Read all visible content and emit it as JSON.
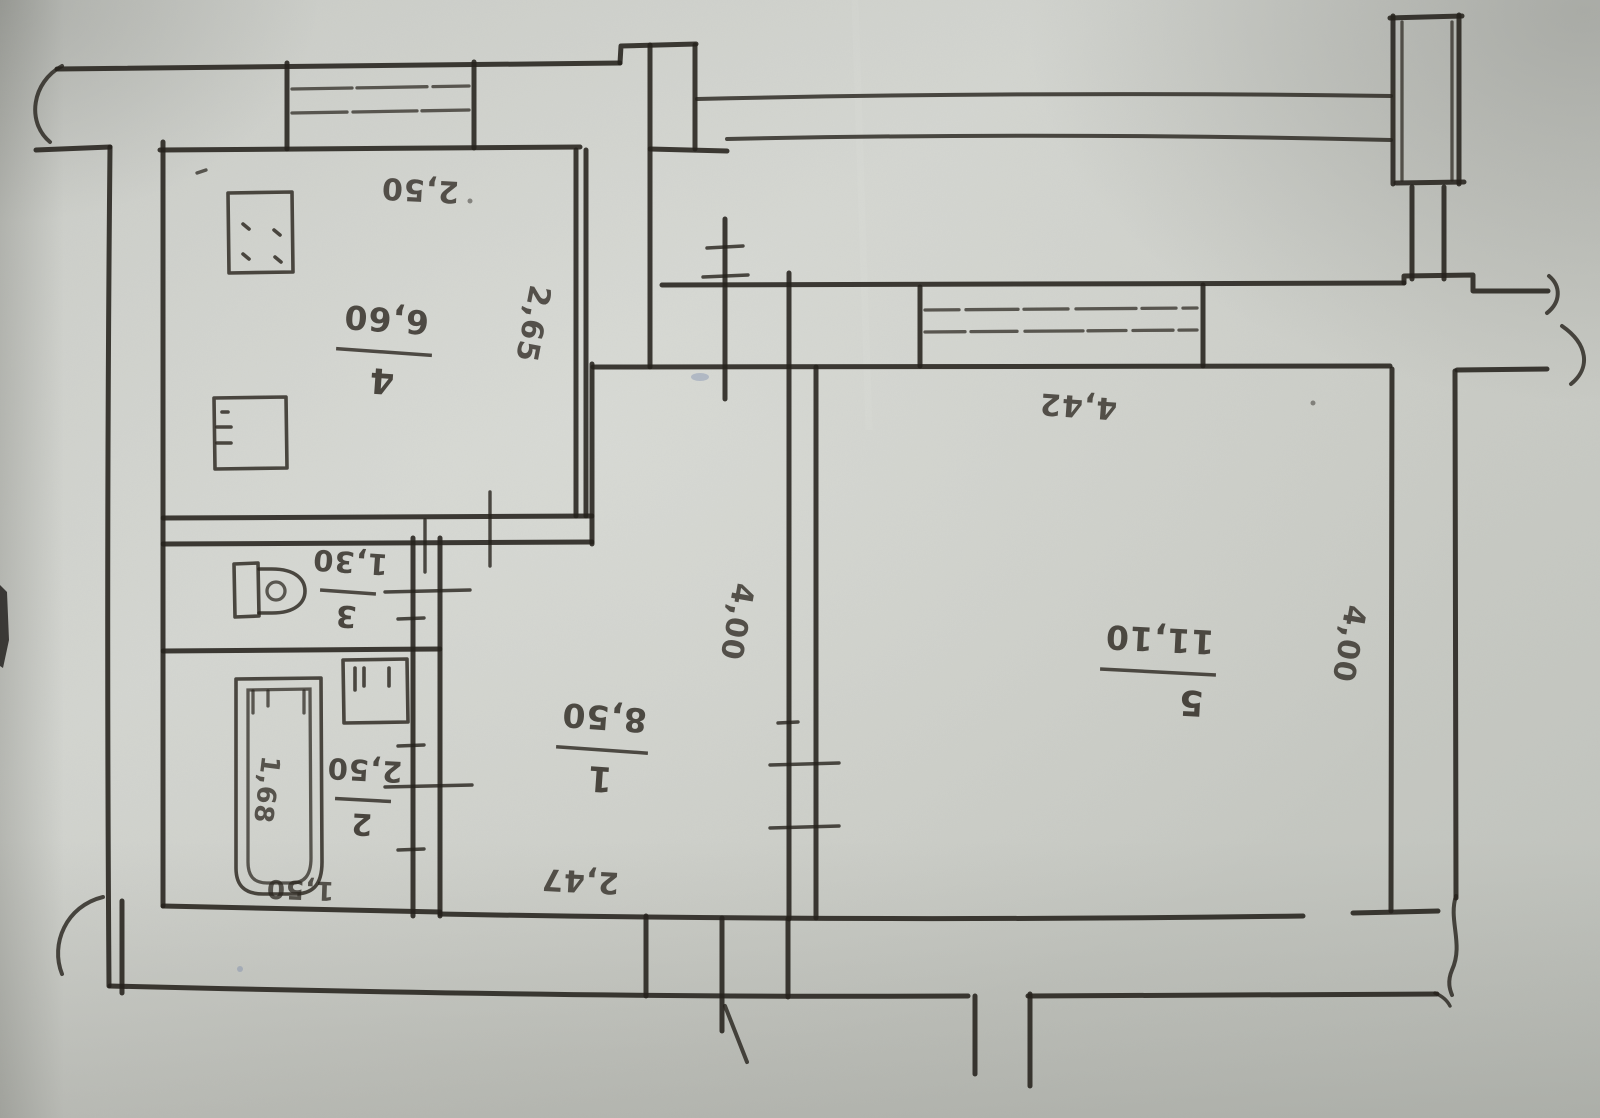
{
  "colors": {
    "paper": "#cbcdc7",
    "ink": "#26221c",
    "pen_blue": "#5e6fa3"
  },
  "rooms": {
    "r1": {
      "number": "1",
      "area": "8,50"
    },
    "r2": {
      "number": "2",
      "area": "2,50"
    },
    "r3": {
      "number": "3",
      "area": "1,30"
    },
    "r4": {
      "number": "4",
      "area": "6,60"
    },
    "r5": {
      "number": "5",
      "area": "11,10"
    }
  },
  "dimensions": {
    "kitchen_width": "2,50",
    "kitchen_depth": "2,65",
    "entry_width": "4,42",
    "hall_depth": "4,00",
    "hall_width": "2,47",
    "room5_depth": "4,00",
    "bath_width": "1,50",
    "bathtub_length": "1,68"
  },
  "fixtures": [
    "stove-icon",
    "kitchen-cabinet-icon",
    "toilet-icon",
    "washbasin-icon",
    "bathtub-icon",
    "window-icon",
    "balcony-railing-icon",
    "door-arc-icon"
  ]
}
